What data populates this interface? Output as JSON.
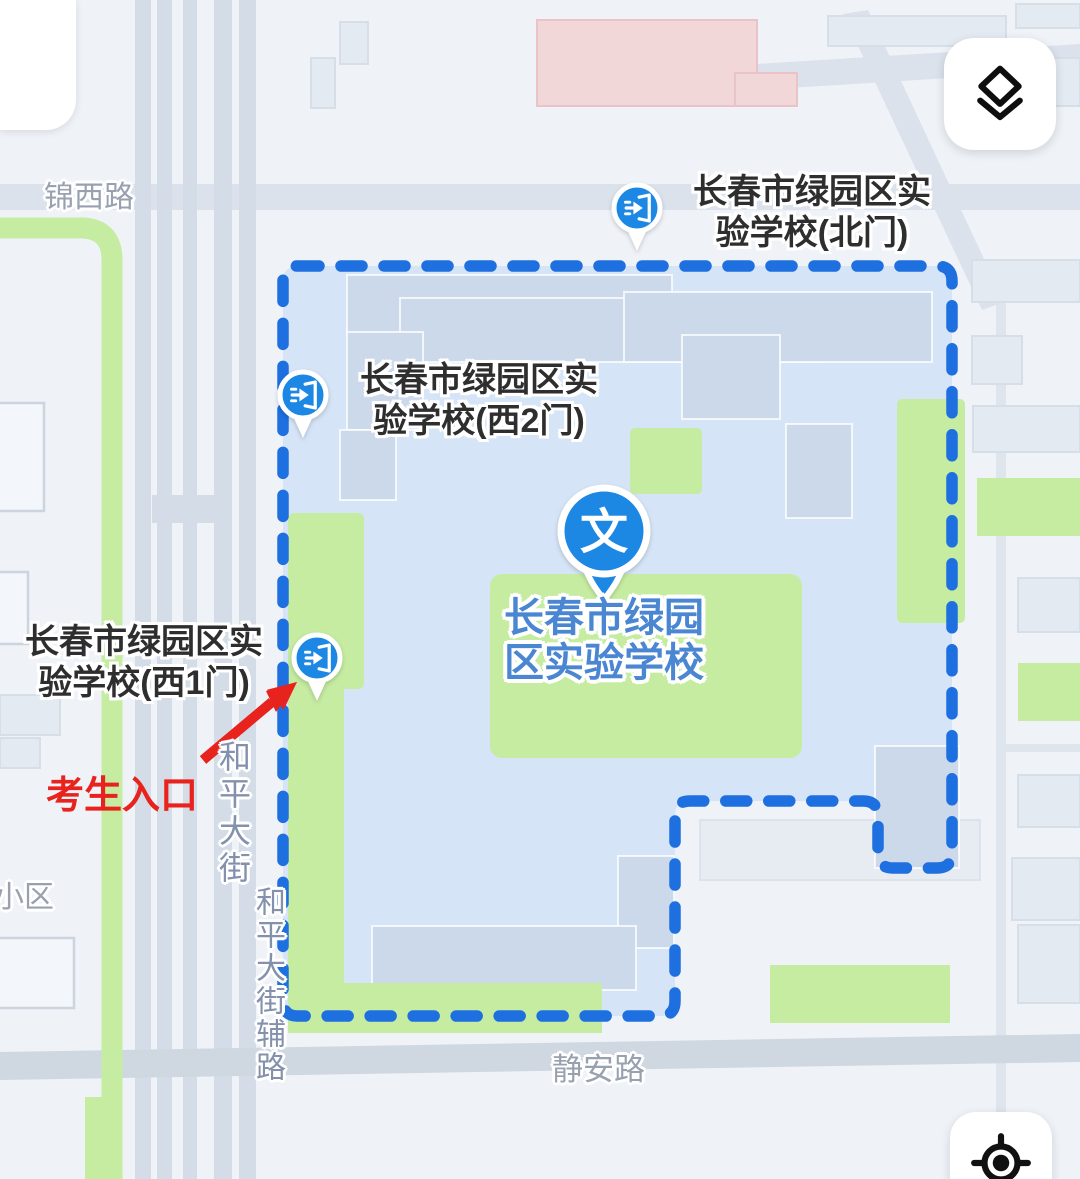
{
  "map": {
    "poi": {
      "marker_glyph": "文",
      "name_line1": "长春市绿园",
      "name_line2": "区实验学校"
    },
    "gates": {
      "north": {
        "line1": "长春市绿园区实",
        "line2": "验学校(北门)"
      },
      "west2": {
        "line1": "长春市绿园区实",
        "line2": "验学校(西2门)"
      },
      "west1": {
        "line1": "长春市绿园区实",
        "line2": "验学校(西1门)"
      }
    },
    "annotation": {
      "exam_entrance": "考生入口"
    },
    "roads": {
      "jinxi": "锦西路",
      "heping": "和平大街",
      "heping_fu": "和平大街辅路",
      "jingan": "静安路",
      "residential": "小区"
    }
  },
  "colors": {
    "boundary": "#1e6fe0",
    "marker": "#1d87e4",
    "campus": "#d5e4f6",
    "green": "#c6eca2",
    "poiblue": "#4a86d2",
    "red": "#e8221c",
    "road": "#d4dde7",
    "bld": "#e4eaf2",
    "campusbld": "#cbd9ea",
    "pink": "#f2d7d8"
  }
}
